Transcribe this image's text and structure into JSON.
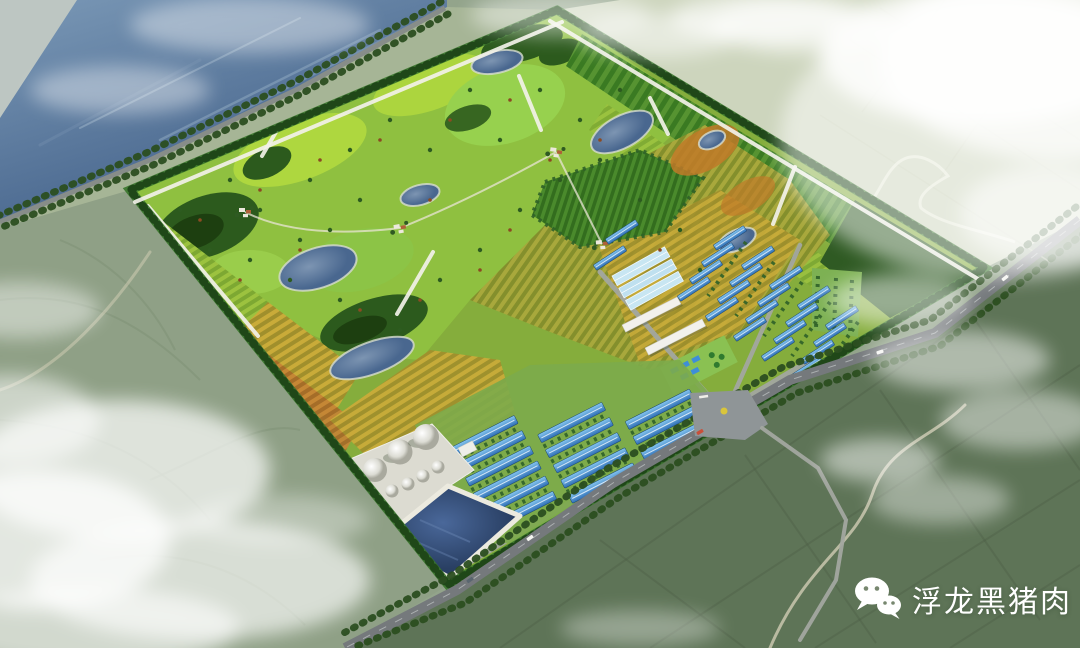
{
  "watermark": {
    "icon": "wechat-icon",
    "text": "浮龙黑猪肉"
  },
  "scene": {
    "regions": [
      "river",
      "riverbank-road",
      "surrounding-farmland",
      "planned-farm-site",
      "park-zone",
      "forest-mounds",
      "ponds",
      "crop-fields",
      "orchard-strip",
      "villa-clusters",
      "greenhouse-block",
      "office-buildings",
      "barn-cluster-north",
      "barn-cluster-south",
      "silo-group",
      "storage-pond",
      "main-road",
      "entrance-plaza",
      "clouds"
    ]
  },
  "palette": {
    "river_blue": "#4f6f96",
    "field_sage": "#8fa086",
    "field_dark_green": "#5e7457",
    "field_pale": "#cdd5bd",
    "park_green": "#8fc040",
    "park_bright": "#b5dc3e",
    "forest_dark": "#2c5a1d",
    "crop_gold": "#c9ab39",
    "crop_orange": "#c58435",
    "pond_blue": "#5e7da3",
    "barn_roof_blue": "#4a9be0",
    "greenhouse_blue": "#c8e6f2",
    "building_white": "#f2f1ec",
    "road_grey": "#75797c",
    "path_white": "#f1f0e8",
    "storage_pond_navy": "#2e4a74",
    "cloud_white": "#ffffff",
    "watermark_white": "#ffffff"
  }
}
